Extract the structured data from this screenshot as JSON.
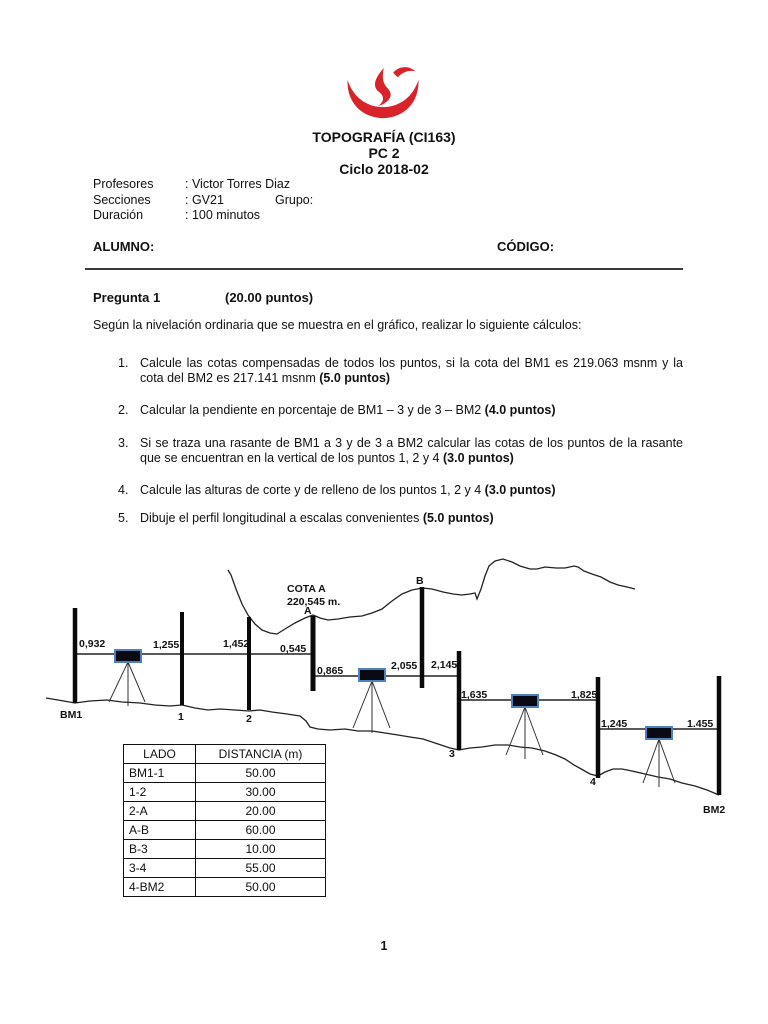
{
  "header": {
    "title": "TOPOGRAFÍA (CI163)",
    "subtitle": "PC 2",
    "cycle": "Ciclo 2018-02",
    "info": [
      {
        "label": "Profesores",
        "value": ": Victor Torres Diaz",
        "extra": ""
      },
      {
        "label": "Secciones",
        "value": ": GV21",
        "extra": "Grupo:"
      },
      {
        "label": "Duración",
        "value": ": 100 minutos",
        "extra": ""
      }
    ],
    "alumno_label": "ALUMNO:",
    "codigo_label": "CÓDIGO:"
  },
  "question": {
    "title": "Pregunta 1",
    "points": "(20.00 puntos)",
    "intro": "Según la nivelación ordinaria que se muestra en el gráfico, realizar lo siguiente cálculos:",
    "items": [
      {
        "num": "1.",
        "text": "Calcule las cotas compensadas de todos los puntos, si la cota del BM1 es 219.063 msnm y la cota del BM2 es 217.141 msnm ",
        "bold": "(5.0 puntos)"
      },
      {
        "num": "2.",
        "text": "Calcular la pendiente en porcentaje de BM1 – 3 y de 3 – BM2 ",
        "bold": "(4.0 puntos)"
      },
      {
        "num": "3.",
        "text": "Si se traza una rasante de BM1 a 3 y de 3 a BM2 calcular las cotas de los puntos de la rasante que se encuentran en la vertical de los puntos 1, 2 y 4 ",
        "bold": "(3.0 puntos)"
      },
      {
        "num": "4.",
        "text": "Calcule las alturas de corte y de relleno de los puntos 1, 2 y 4 ",
        "bold": "(3.0 puntos)"
      },
      {
        "num": "5.",
        "text": "Dibuje el perfil longitudinal a escalas convenientes ",
        "bold": "(5.0 puntos)"
      }
    ]
  },
  "diagram": {
    "cota_a_line1": "COTA A",
    "cota_a_line2": "220,545 m.",
    "point_a": "A",
    "point_b": "B",
    "readings": {
      "bm1": "0,932",
      "p1": "1,255",
      "p2": "1,452",
      "a_foresight": "0,545",
      "a_backsight": "0,865",
      "b": "2,055",
      "p3_foresight": "2,145",
      "p3_backsight": "1,635",
      "p4_foresight": "1,825",
      "p4_backsight": "1,245",
      "bm2": "1.455"
    },
    "labels": {
      "bm1": "BM1",
      "p1": "1",
      "p2": "2",
      "p3": "3",
      "p4": "4",
      "bm2": "BM2"
    }
  },
  "table": {
    "headers": [
      "LADO",
      "DISTANCIA (m)"
    ],
    "rows": [
      [
        "BM1-1",
        "50.00"
      ],
      [
        "1-2",
        "30.00"
      ],
      [
        "2-A",
        "20.00"
      ],
      [
        "A-B",
        "60.00"
      ],
      [
        "B-3",
        "10.00"
      ],
      [
        "3-4",
        "55.00"
      ],
      [
        "4-BM2",
        "50.00"
      ]
    ]
  },
  "footer": {
    "page": "1"
  },
  "colors": {
    "logo_red": "#D8232A",
    "instrument_border": "#4f81bd"
  }
}
